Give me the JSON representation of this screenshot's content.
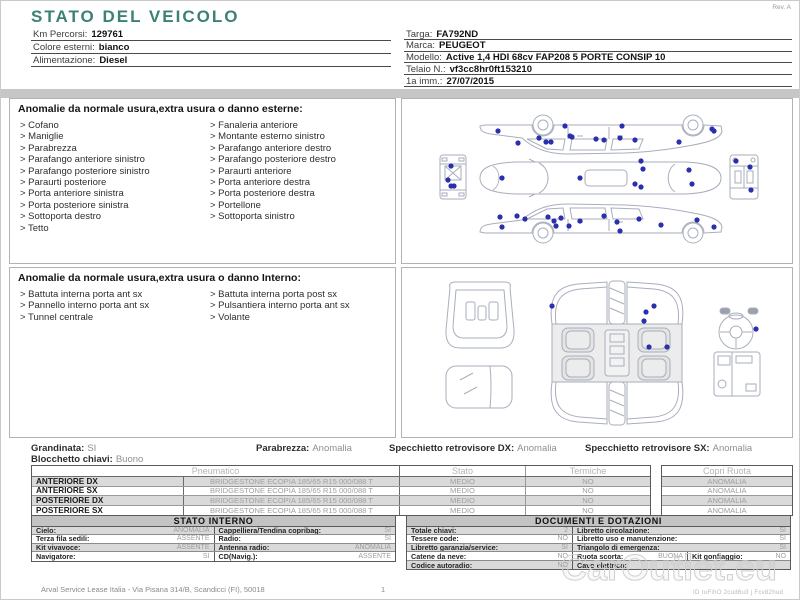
{
  "header": {
    "title": "STATO DEL VEICOLO",
    "rev": "Rev. A",
    "left_fields": [
      {
        "label": "Km Percorsi:",
        "value": "129761"
      },
      {
        "label": "Colore esterni:",
        "value": "bianco"
      },
      {
        "label": "Alimentazione:",
        "value": "Diesel"
      }
    ],
    "right_fields": [
      {
        "label": "Targa:",
        "value": "FA792ND"
      },
      {
        "label": "Marca:",
        "value": "PEUGEOT"
      },
      {
        "label": "Modello:",
        "value": "Active 1,4 HDI 68cv FAP208 5 PORTE CONSIP 10"
      },
      {
        "label": "Telaio N.:",
        "value": "vf3cc8hr0ft153210"
      },
      {
        "label": "1a imm.:",
        "value": "27/07/2015"
      }
    ]
  },
  "bullet": ">",
  "exterior_anomalies": {
    "title": "Anomalie da normale usura,extra usura o danno esterne:",
    "col1": [
      "Cofano",
      "Maniglie",
      "Parabrezza",
      "Parafango anteriore sinistro",
      "Parafango posteriore sinistro",
      "Paraurti posteriore",
      "Porta anteriore sinistra",
      "Porta posteriore sinistra",
      "Sottoporta destro",
      "Tetto"
    ],
    "col2": [
      "Fanaleria anteriore",
      "Montante esterno sinistro",
      "Parafango anteriore destro",
      "Parafango posteriore destro",
      "Paraurti anteriore",
      "Porta anteriore destra",
      "Porta posteriore destra",
      "Portellone",
      "Sottoporta sinistro"
    ]
  },
  "interior_anomalies": {
    "title": "Anomalie da normale usura,extra usura o danno Interno:",
    "col1": [
      "Battuta interna porta ant sx",
      "Pannello interno porta ant sx",
      "Tunnel centrale"
    ],
    "col2": [
      "Battuta interna porta post sx",
      "Pulsantiera interno porta ant sx",
      "Volante"
    ]
  },
  "status_line": {
    "grandinata": {
      "label": "Grandinata:",
      "value": "SI"
    },
    "parabrezza": {
      "label": "Parabrezza:",
      "value": "Anomalia"
    },
    "specchietto_dx": {
      "label": "Specchietto retrovisore DX:",
      "value": "Anomalia"
    },
    "specchietto_sx": {
      "label": "Specchietto retrovisore SX:",
      "value": "Anomalia"
    },
    "blocchetto": {
      "label": "Blocchetto chiavi:",
      "value": "Buono"
    }
  },
  "tires": {
    "headers": {
      "pneumatico": "Pneumatico",
      "stato": "Stato",
      "termiche": "Termiche",
      "copri_ruota": "Copri Ruota"
    },
    "rows": [
      {
        "position": "ANTERIORE DX",
        "spec": "BRIDGESTONE  ECOPIA 185/65 R15 000/088 T",
        "stato": "MEDIO",
        "termiche": "NO",
        "copri_ruota": "ANOMALIA"
      },
      {
        "position": "ANTERIORE SX",
        "spec": "BRIDGESTONE  ECOPIA 185/65 R15 000/088 T",
        "stato": "MEDIO",
        "termiche": "NO",
        "copri_ruota": "ANOMALIA"
      },
      {
        "position": "POSTERIORE DX",
        "spec": "BRIDGESTONE  ECOPIA 185/65 R15 000/088 T",
        "stato": "MEDIO",
        "termiche": "NO",
        "copri_ruota": "ANOMALIA"
      },
      {
        "position": "POSTERIORE SX",
        "spec": "BRIDGESTONE  ECOPIA 185/65 R15 000/088 T",
        "stato": "MEDIO",
        "termiche": "NO",
        "copri_ruota": "ANOMALIA"
      }
    ]
  },
  "stato_interno": {
    "title": "STATO INTERNO",
    "rows": [
      [
        {
          "label": "Cielo:",
          "value": "ANOMALIA"
        },
        {
          "label": "Cappelliera/Tendina copribag:",
          "value": "SI"
        }
      ],
      [
        {
          "label": "Terza fila sedili:",
          "value": "ASSENTE"
        },
        {
          "label": "Radio:",
          "value": "SI"
        }
      ],
      [
        {
          "label": "Kit vivavoce:",
          "value": "ASSENTE"
        },
        {
          "label": "Antenna radio:",
          "value": "ANOMALIA"
        }
      ],
      [
        {
          "label": "Navigatore:",
          "value": "SI"
        },
        {
          "label": "CD(Navig.):",
          "value": "ASSENTE"
        }
      ]
    ]
  },
  "documenti": {
    "title": "DOCUMENTI E DOTAZIONI",
    "rows": [
      [
        {
          "label": "Totale chiavi:",
          "value": "2"
        },
        {
          "label": "Libretto circolazione:",
          "value": "SI"
        }
      ],
      [
        {
          "label": "Tessere code:",
          "value": "NO"
        },
        {
          "label": "Libretto uso e manutenzione:",
          "value": "SI"
        }
      ],
      [
        {
          "label": "Libretto garanzia/service:",
          "value": "SI"
        },
        {
          "label": "Triangolo di emergenza:",
          "value": "SI"
        }
      ],
      [
        {
          "label": "Catene da neve:",
          "value": "NO"
        },
        {
          "label": "Ruota scorta:",
          "value": "BUONA"
        },
        {
          "label": "Kit gonfiaggio:",
          "value": "NO"
        }
      ],
      [
        {
          "label": "Codice autoradio:",
          "value": "NO"
        },
        {
          "label": "Cavo elettrico:",
          "value": ""
        }
      ]
    ]
  },
  "footer": {
    "company": "Arval Service Lease Italia - Via Pisana 314/B, Scandicci (FI), 50018",
    "page": "1"
  },
  "watermark": {
    "text": "CarOutlet.eu",
    "id_line": "ID ruFihO 2cud6u3 j Fcv82hud"
  },
  "diagrams": {
    "exterior_dots": [
      [
        96,
        32
      ],
      [
        116,
        44
      ],
      [
        137,
        39
      ],
      [
        144,
        43
      ],
      [
        149,
        43
      ],
      [
        163,
        27
      ],
      [
        168,
        37
      ],
      [
        170,
        38
      ],
      [
        194,
        40
      ],
      [
        202,
        41
      ],
      [
        220,
        27
      ],
      [
        218,
        39
      ],
      [
        233,
        41
      ],
      [
        277,
        43
      ],
      [
        310,
        30
      ],
      [
        312,
        32
      ],
      [
        49,
        67
      ],
      [
        46,
        81
      ],
      [
        49,
        87
      ],
      [
        52,
        87
      ],
      [
        100,
        79
      ],
      [
        178,
        79
      ],
      [
        239,
        62
      ],
      [
        241,
        70
      ],
      [
        233,
        85
      ],
      [
        239,
        88
      ],
      [
        287,
        71
      ],
      [
        290,
        85
      ],
      [
        334,
        62
      ],
      [
        348,
        68
      ],
      [
        349,
        91
      ],
      [
        98,
        118
      ],
      [
        100,
        128
      ],
      [
        115,
        117
      ],
      [
        123,
        120
      ],
      [
        146,
        118
      ],
      [
        152,
        122
      ],
      [
        154,
        127
      ],
      [
        159,
        119
      ],
      [
        167,
        127
      ],
      [
        178,
        122
      ],
      [
        202,
        117
      ],
      [
        215,
        123
      ],
      [
        218,
        132
      ],
      [
        237,
        120
      ],
      [
        259,
        126
      ],
      [
        295,
        121
      ],
      [
        312,
        128
      ]
    ],
    "interior_dots": [
      [
        150,
        38
      ],
      [
        252,
        38
      ],
      [
        244,
        44
      ],
      [
        242,
        53
      ],
      [
        247,
        79
      ],
      [
        265,
        79
      ],
      [
        354,
        61
      ]
    ]
  },
  "colors": {
    "accent_title": "#3b8274",
    "damage_dot": "#2a2fae",
    "gray_bar": "#c6c6c6",
    "header_bar": "#c3c3c3",
    "alt_row": "#dadada"
  }
}
